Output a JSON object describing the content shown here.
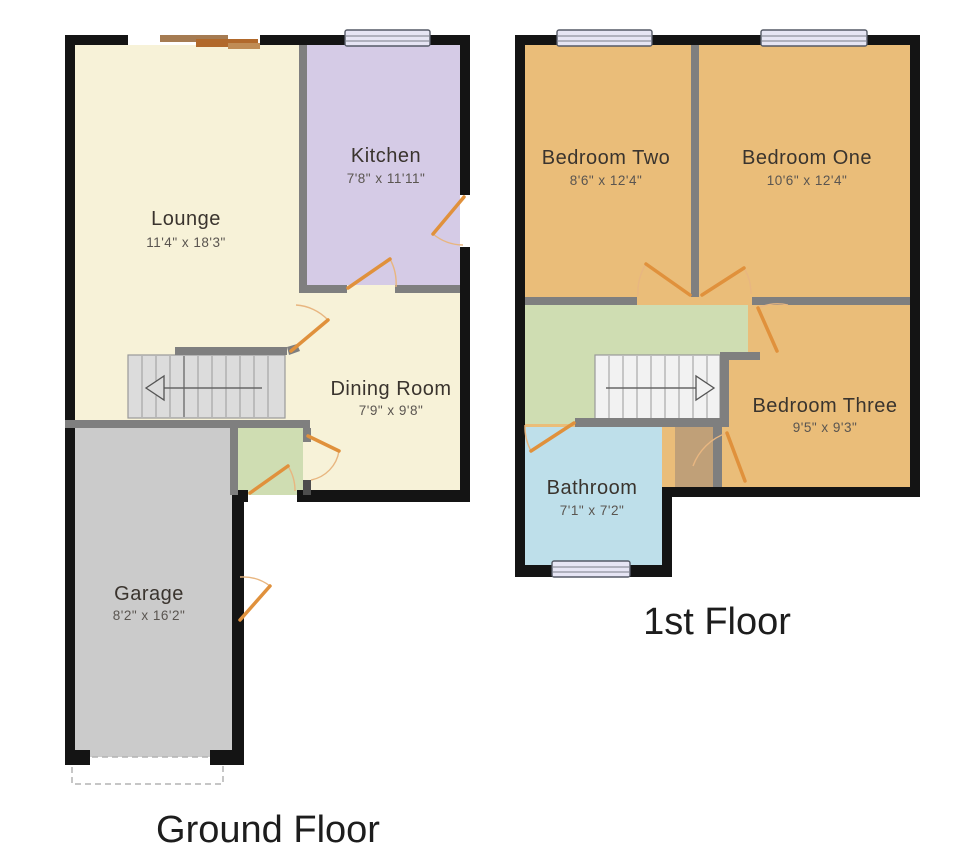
{
  "floors": {
    "ground": {
      "label": "Ground Floor",
      "rooms": {
        "lounge": {
          "name": "Lounge",
          "dims": "11'4\" x 18'3\""
        },
        "kitchen": {
          "name": "Kitchen",
          "dims": "7'8\" x 11'11\""
        },
        "dining": {
          "name": "Dining Room",
          "dims": "7'9\" x 9'8\""
        },
        "garage": {
          "name": "Garage",
          "dims": "8'2\" x 16'2\""
        }
      }
    },
    "first": {
      "label": "1st Floor",
      "rooms": {
        "bedroom_two": {
          "name": "Bedroom Two",
          "dims": "8'6\" x 12'4\""
        },
        "bedroom_one": {
          "name": "Bedroom One",
          "dims": "10'6\" x 12'4\""
        },
        "bedroom_three": {
          "name": "Bedroom Three",
          "dims": "9'5\" x 9'3\""
        },
        "bathroom": {
          "name": "Bathroom",
          "dims": "7'1\" x 7'2\""
        }
      }
    }
  },
  "colors": {
    "background": "#ffffff",
    "wall_exterior": "#141414",
    "wall_interior": "#7f7f7f",
    "lounge_dining": "#f7f2d8",
    "kitchen": "#d5cbe6",
    "bedroom": "#eabd79",
    "bathroom": "#bedfea",
    "hallway_landing": "#cfddb2",
    "garage": "#cbcbcb",
    "cupboard": "#c0a078",
    "stairs_ground": "#dcdcdc",
    "stairs_first": "#f2f2f2",
    "door": "#e0913c",
    "door_arc": "#e8b680",
    "window_fill": "#e6e5f4",
    "window_border": "#555a66",
    "room_text": "#3a342e",
    "dims_text": "#5a5550"
  }
}
